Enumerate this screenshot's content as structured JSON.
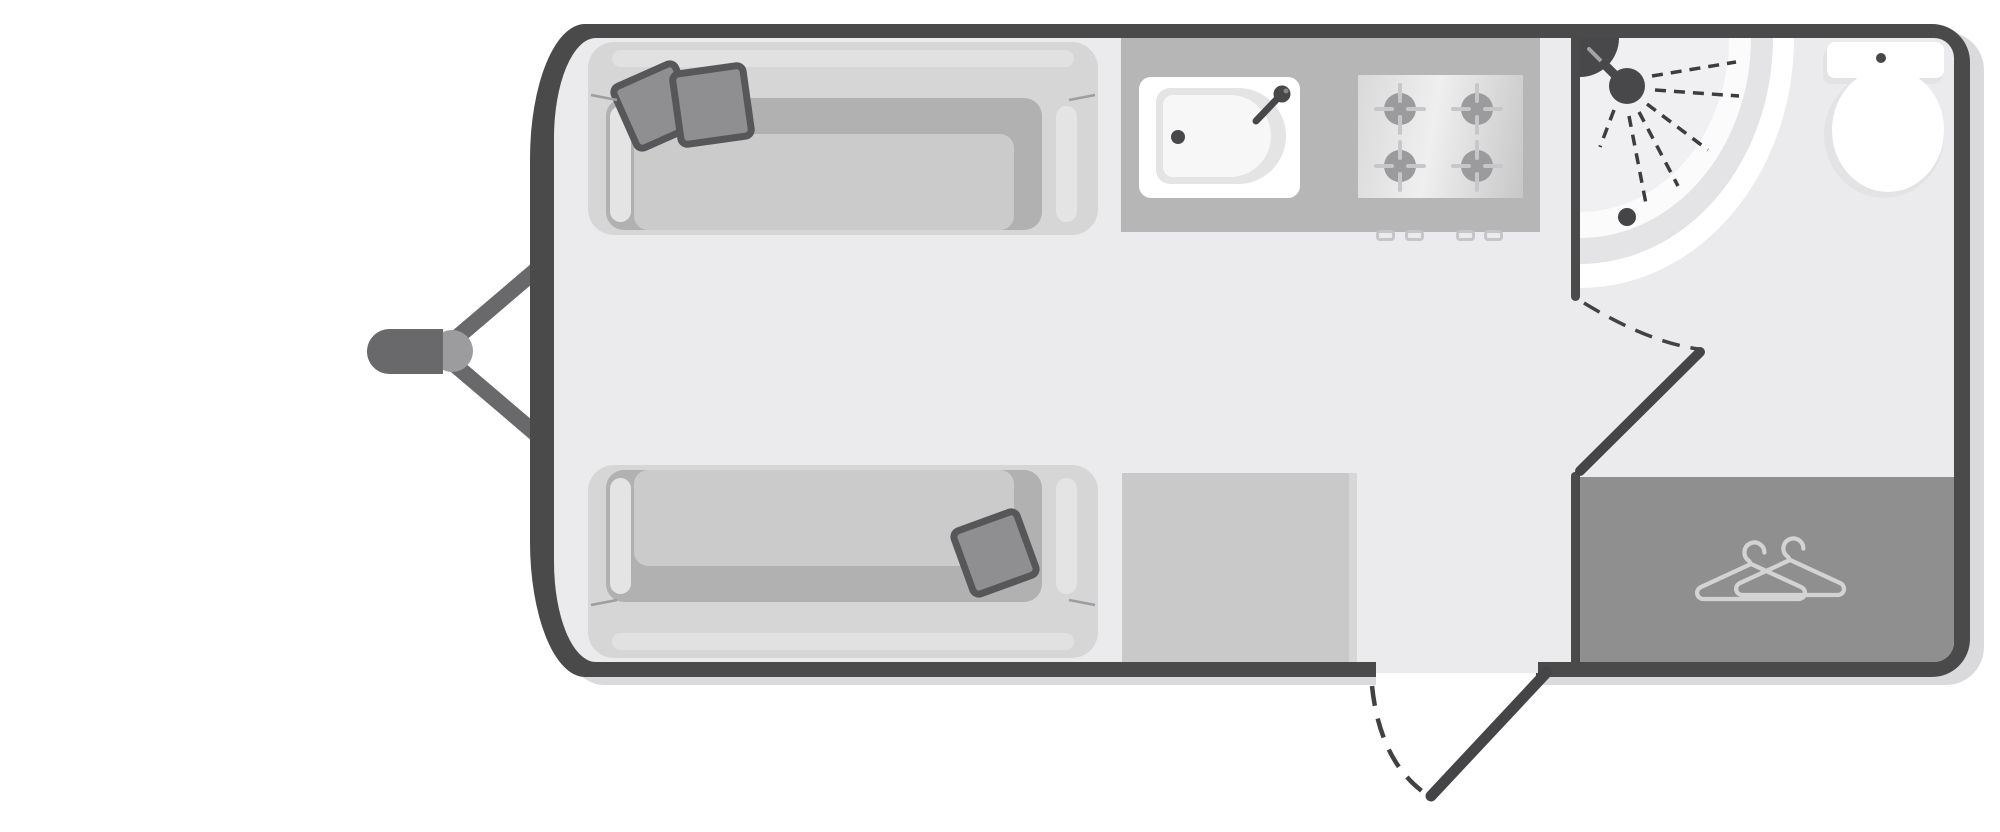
{
  "diagram": {
    "type": "caravan-floorplan",
    "view": "top-down",
    "orientation": "hitch-left",
    "rooms": [
      {
        "name": "front-lounge",
        "fixtures": [
          "sofa-top",
          "sofa-bottom",
          "scatter-pillow-1",
          "scatter-pillow-2",
          "scatter-pillow-3"
        ]
      },
      {
        "name": "kitchen",
        "fixtures": [
          "kitchen-counter",
          "sink",
          "faucet",
          "hob-4-burner",
          "stove-knobs",
          "lower-counter"
        ]
      },
      {
        "name": "washroom",
        "fixtures": [
          "corner-shower",
          "shower-head",
          "shower-spray",
          "shower-drain",
          "toilet-cistern",
          "toilet-bowl",
          "washroom-door"
        ]
      },
      {
        "name": "wardrobe",
        "fixtures": [
          "wardrobe-cabinet",
          "clothes-hangers-icon"
        ]
      }
    ],
    "exterior": [
      "tow-hitch",
      "a-frame-struts",
      "entry-door",
      "entry-door-swing"
    ],
    "counts": {
      "sofas": 2,
      "pillows": 3,
      "hob_burners": 4,
      "stove_knobs": 4,
      "hangers": 2
    }
  },
  "colors": {
    "wall": "#4a4a4b",
    "floor": "#ebebed",
    "shadow": "#dadadc",
    "sofa": "#d6d6d7",
    "sofaStripe": "#e1e1e2",
    "well": "#b1b1b2",
    "cushion": "#cbcbcc",
    "armrest": "#e4e4e5",
    "pillow": "#8f8f91",
    "pillowEdge": "#57575a",
    "counter": "#b6b6b7",
    "counterLow": "#c9c9ca",
    "burner": "#9b9b9d",
    "tick": "#c7c7c9",
    "wardrobe": "#8f8f90",
    "hanger": "#d3d3d4",
    "hitch": "#69696b",
    "coupling": "#9c9c9e",
    "accentDark": "#48484a",
    "spray": "#3d3d3f",
    "white": "#ffffff"
  }
}
